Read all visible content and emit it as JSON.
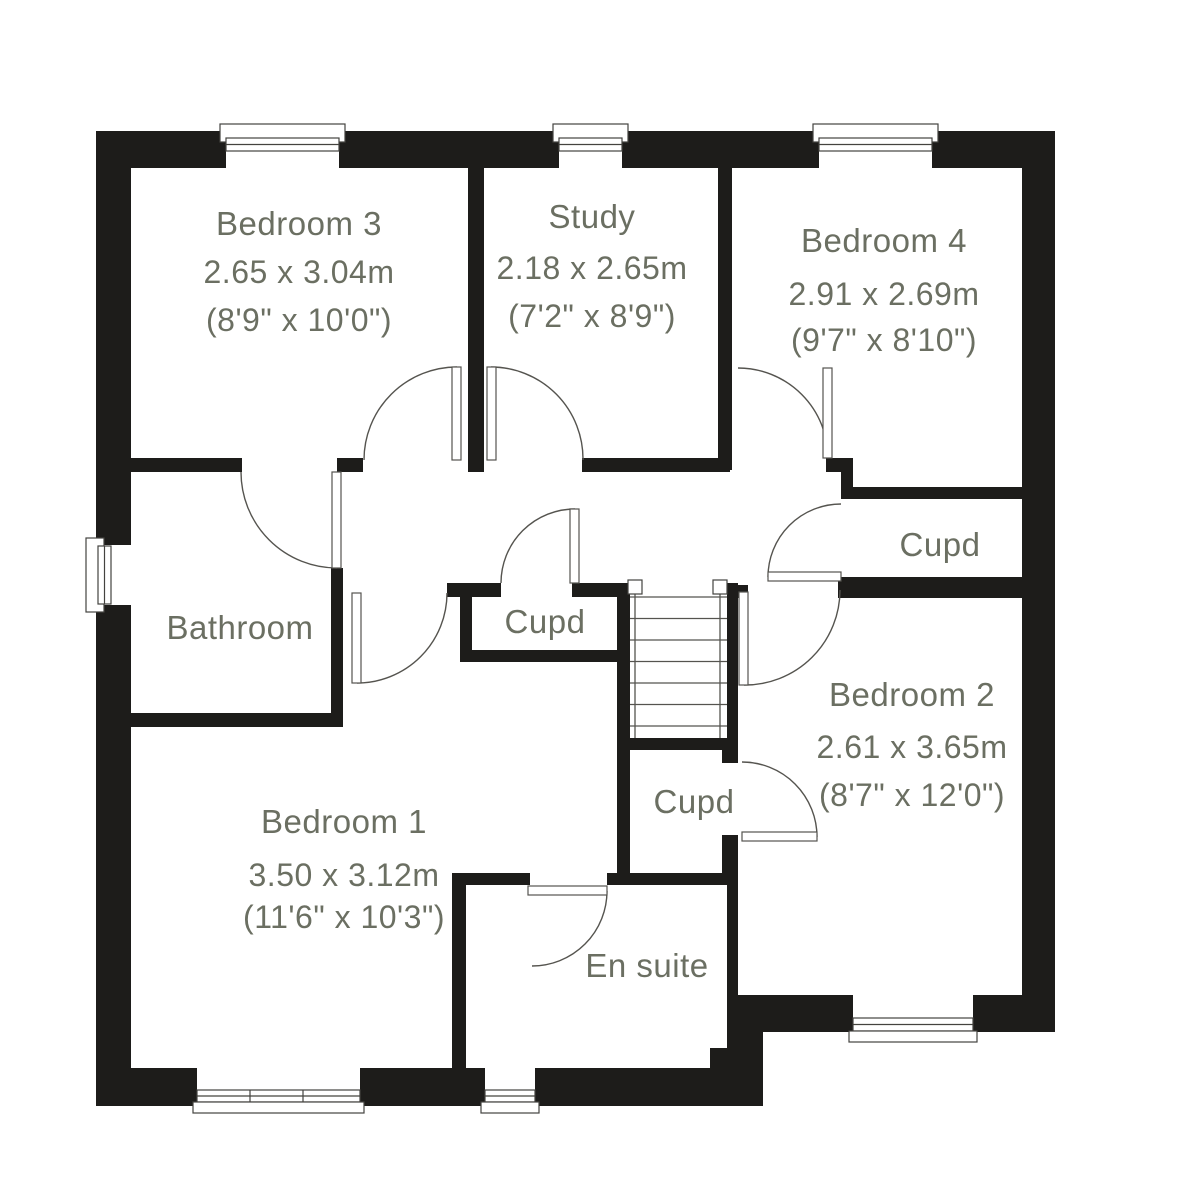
{
  "rooms": {
    "bedroom3": {
      "name": "Bedroom 3",
      "metric": "2.65 x 3.04m",
      "imperial": "(8'9\" x 10'0\")"
    },
    "study": {
      "name": "Study",
      "metric": "2.18 x 2.65m",
      "imperial": "(7'2\" x 8'9\")"
    },
    "bedroom4": {
      "name": "Bedroom 4",
      "metric": "2.91 x 2.69m",
      "imperial": "(9'7\" x 8'10\")"
    },
    "bathroom": {
      "name": "Bathroom"
    },
    "cupboard_hall": {
      "name": "Cupd"
    },
    "cupboard_landing": {
      "name": "Cupd"
    },
    "cupboard_bedroom2": {
      "name": "Cupd"
    },
    "bedroom2": {
      "name": "Bedroom 2",
      "metric": "2.61 x 3.65m",
      "imperial": "(8'7\" x 12'0\")"
    },
    "bedroom1": {
      "name": "Bedroom 1",
      "metric": "3.50 x 3.12m",
      "imperial": "(11'6\" x 10'3\")"
    },
    "ensuite": {
      "name": "En suite"
    }
  },
  "colors": {
    "wall": "#1d1c1a",
    "label_text": "#6b6f62",
    "line": "#55544f",
    "background": "#ffffff"
  }
}
